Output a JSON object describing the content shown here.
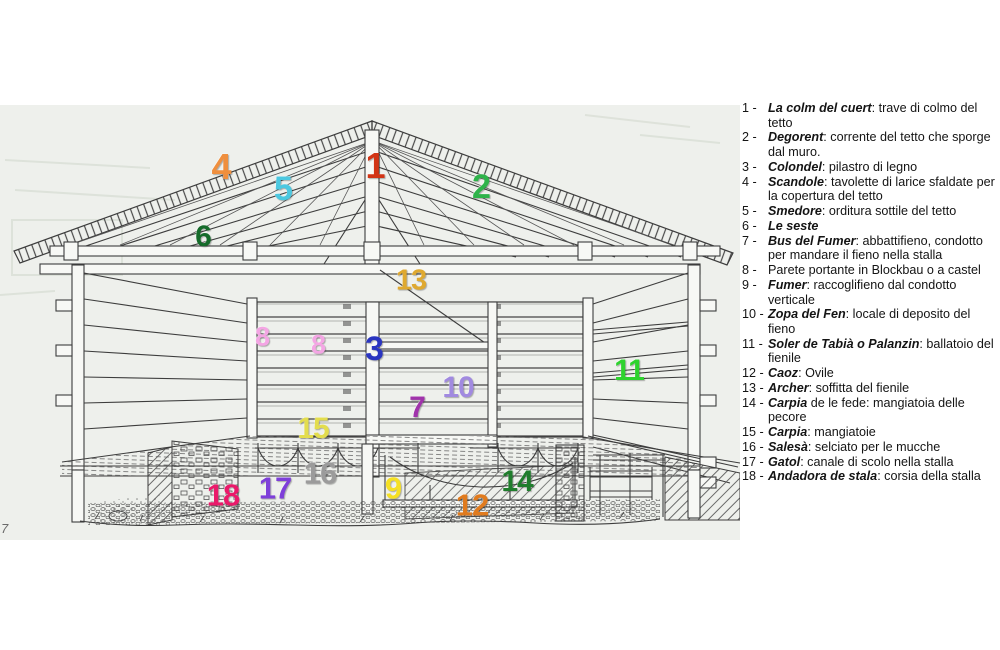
{
  "page": {
    "background": "#ffffff",
    "scan_background": "#eef0ec"
  },
  "diagram": {
    "corner_mark": "7",
    "labels": [
      {
        "n": "1",
        "x": 375,
        "y": 166,
        "size": 36,
        "color": "#d23415"
      },
      {
        "n": "4",
        "x": 221,
        "y": 167,
        "size": 36,
        "color": "#ef8f3e"
      },
      {
        "n": "5",
        "x": 283,
        "y": 189,
        "size": 34,
        "color": "#4cc8e0"
      },
      {
        "n": "2",
        "x": 481,
        "y": 187,
        "size": 34,
        "color": "#2eb34a"
      },
      {
        "n": "6",
        "x": 203,
        "y": 237,
        "size": 30,
        "color": "#156b2a"
      },
      {
        "n": "13",
        "x": 411,
        "y": 281,
        "size": 29,
        "color": "#dfa930"
      },
      {
        "n": "8",
        "x": 262,
        "y": 337,
        "size": 27,
        "color": "#f4a6e4"
      },
      {
        "n": "8",
        "x": 318,
        "y": 345,
        "size": 27,
        "color": "#f4a6e4"
      },
      {
        "n": "3",
        "x": 374,
        "y": 349,
        "size": 34,
        "color": "#2a35c0"
      },
      {
        "n": "11",
        "x": 629,
        "y": 371,
        "size": 30,
        "color": "#2ed32e"
      },
      {
        "n": "10",
        "x": 458,
        "y": 388,
        "size": 30,
        "color": "#a18ae0"
      },
      {
        "n": "7",
        "x": 417,
        "y": 408,
        "size": 30,
        "color": "#a033ab"
      },
      {
        "n": "15",
        "x": 313,
        "y": 429,
        "size": 30,
        "color": "#e3dd4e"
      },
      {
        "n": "16",
        "x": 320,
        "y": 473,
        "size": 31,
        "color": "#9b9b9b"
      },
      {
        "n": "17",
        "x": 275,
        "y": 488,
        "size": 31,
        "color": "#7e3fd9"
      },
      {
        "n": "18",
        "x": 223,
        "y": 495,
        "size": 31,
        "color": "#ea1a6a"
      },
      {
        "n": "9",
        "x": 393,
        "y": 488,
        "size": 31,
        "color": "#f5e023"
      },
      {
        "n": "12",
        "x": 472,
        "y": 505,
        "size": 31,
        "color": "#e07b1e"
      },
      {
        "n": "14",
        "x": 517,
        "y": 482,
        "size": 30,
        "color": "#1f7d2c"
      }
    ]
  },
  "legend": {
    "items": [
      {
        "prefix": "1 - ",
        "term": "La colm del cuert",
        "desc": ": trave di colmo del tetto"
      },
      {
        "prefix": "2 - ",
        "term": "Degorent",
        "desc": ": corrente del tetto che sporge dal muro."
      },
      {
        "prefix": "3 - ",
        "term": "Colondel",
        "desc": ": pilastro di legno"
      },
      {
        "prefix": "4 - ",
        "term": "Scandole",
        "desc": ": tavolette di larice sfaldate per la copertura del tetto"
      },
      {
        "prefix": "5 - ",
        "term": "Smedore",
        "desc": ": orditura sottile del tetto"
      },
      {
        "prefix": "6 - ",
        "term": "Le seste",
        "desc": ""
      },
      {
        "prefix": "7 - ",
        "term": "Bus del Fumer",
        "desc": ": abbattifieno, condotto per mandare il fieno nella stalla"
      },
      {
        "prefix": "8 - ",
        "term": "",
        "desc": "Parete portante in Blockbau o a castel"
      },
      {
        "prefix": "9 - ",
        "term": "Fumer",
        "desc": ": raccoglifieno dal condotto verticale"
      },
      {
        "prefix": "10 - ",
        "term": "Zopa del Fen",
        "desc": ": locale di deposito del fieno"
      },
      {
        "prefix": "11 - ",
        "term": "Soler de Tabià o Palanzin",
        "desc": ": ballatoio del fienile"
      },
      {
        "prefix": "12 - ",
        "term": "Caoz",
        "desc": ": Ovile"
      },
      {
        "prefix": "13 - ",
        "term": "Archer",
        "desc": ": soffitta del fienile"
      },
      {
        "prefix": "14 - ",
        "term": "Carpia",
        "desc": " de le fede: mangiatoia delle pecore"
      },
      {
        "prefix": "15 - ",
        "term": "Carpia",
        "desc": ": mangiatoie"
      },
      {
        "prefix": "16 - ",
        "term": "Salesà",
        "desc": ": selciato per le mucche"
      },
      {
        "prefix": "17 - ",
        "term": "Gatol",
        "desc": ": canale di scolo nella stalla"
      },
      {
        "prefix": "18 - ",
        "term": "Andadora de stala",
        "desc": ": corsia della stalla"
      }
    ]
  }
}
